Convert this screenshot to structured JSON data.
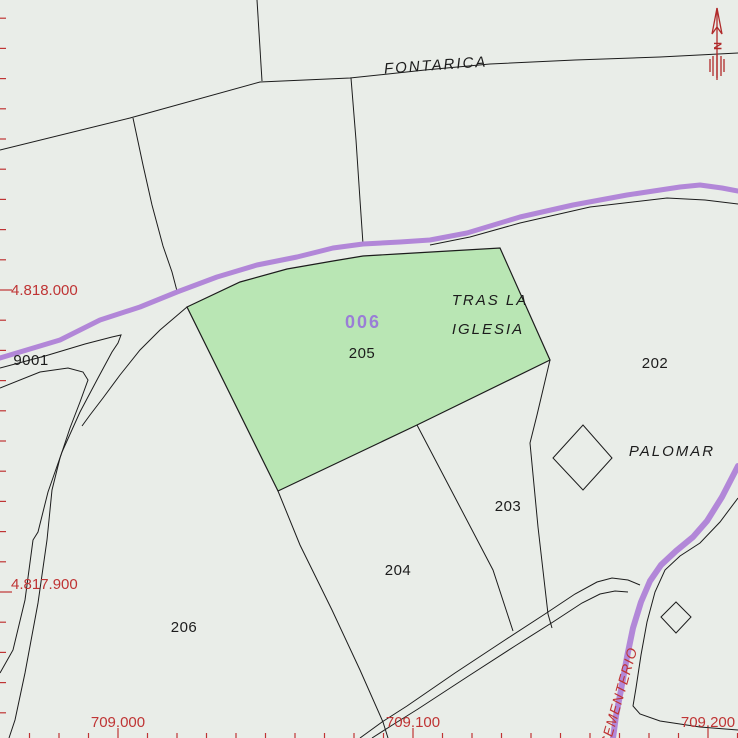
{
  "map": {
    "type": "cadastral-parcel-map",
    "colors": {
      "background": "#e9ede8",
      "highlight_fill": "#b9e6b4",
      "road": "#b287d8",
      "boundary": "#1c1c1c",
      "grid_red": "#bf3434",
      "highlight_code_purple": "#9a7ed6",
      "north_arrow_red": "#b02a2a"
    },
    "highlighted_parcel": {
      "code": "006",
      "number": "205"
    },
    "parcel_numbers": {
      "p202": "202",
      "p203": "203",
      "p204": "204",
      "p206": "206",
      "p9001": "9001"
    },
    "toponyms": {
      "fontarica": "FONTARICA",
      "tras_la": "TRAS LA",
      "iglesia": "IGLESIA",
      "palomar": "PALOMAR",
      "cementerio": "CEMENTERIO"
    },
    "north_label": "N",
    "grid": {
      "y_labels": [
        {
          "text": "4.818.000",
          "y": 290
        },
        {
          "text": "4.817.900",
          "y": 592
        }
      ],
      "x_labels": [
        {
          "text": "709.000",
          "x": 118
        },
        {
          "text": "709.100",
          "x": 413
        },
        {
          "text": "709.200",
          "x": 708
        }
      ],
      "minor_step_y": 30.2,
      "minor_step_x": 29.5
    }
  }
}
